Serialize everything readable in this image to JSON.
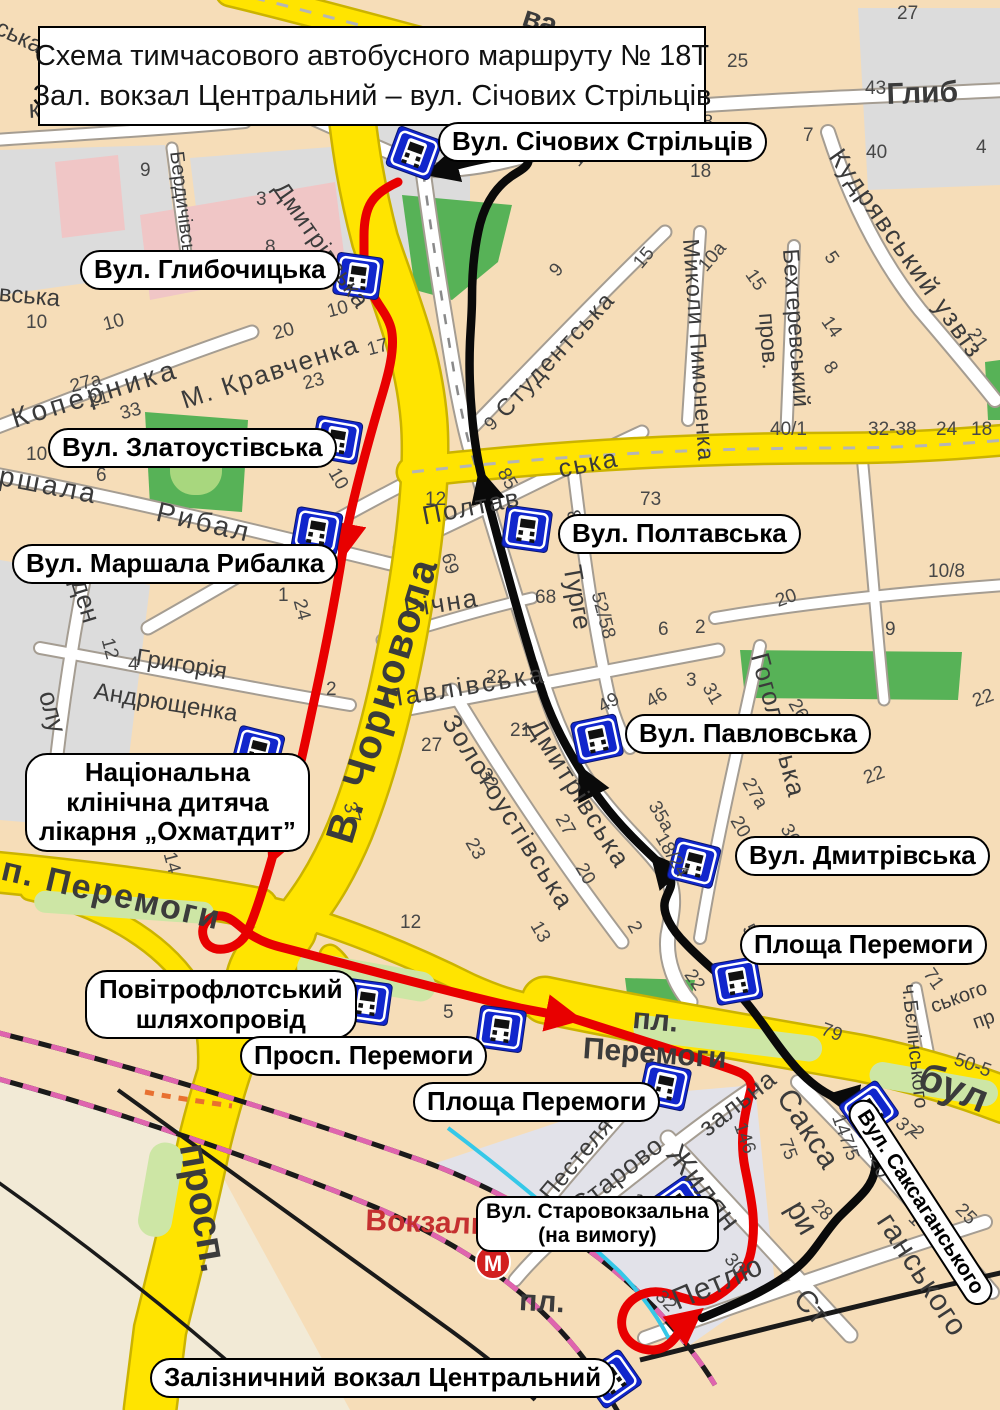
{
  "title": {
    "line1": "Схема тимчасового автобусного маршруту № 18Т",
    "line2": "Зал. вокзал Центральний  – вул. Січових Стрільців"
  },
  "colors": {
    "route_red": "#e80000",
    "route_black": "#0a0a0a",
    "road_yellow": "#ffe400",
    "road_yellow_casing": "#cbb300",
    "road_white": "#ffffff",
    "road_white_casing": "#a59d92",
    "stop_blue": "#1126cc",
    "land": "#f6ddb8",
    "land_gray": "#dcdcdc",
    "land_beige": "#f2ead6",
    "park_green": "#57b257",
    "pill_green": "#cde6a5",
    "block_pink": "#f0c6c6",
    "railway_pink": "#df64ae",
    "water_cyan": "#35c8e8",
    "metro_red": "#d21f1f"
  },
  "metro": {
    "label": "М"
  },
  "station_area_label": "Вокзаль",
  "stops": [
    {
      "id": "sichovykh-striltsiv",
      "lines": [
        "Вул. Січових Стрільців"
      ],
      "x": 438,
      "y": 122,
      "icon": {
        "x": 414,
        "y": 153,
        "r": 20
      }
    },
    {
      "id": "hlybochytska",
      "lines": [
        "Вул. Глибочицька"
      ],
      "x": 80,
      "y": 250,
      "icon": {
        "x": 358,
        "y": 276,
        "r": 8
      }
    },
    {
      "id": "zlatoustivska",
      "lines": [
        "Вул. Златоустівська"
      ],
      "x": 48,
      "y": 428,
      "icon": {
        "x": 337,
        "y": 440,
        "r": 10
      }
    },
    {
      "id": "marshala-rybalky",
      "lines": [
        "Вул. Маршала Рибалка"
      ],
      "x": 12,
      "y": 544,
      "icon": {
        "x": 317,
        "y": 531,
        "r": 10
      }
    },
    {
      "id": "poltavska",
      "lines": [
        "Вул. Полтавська"
      ],
      "x": 558,
      "y": 514,
      "icon": {
        "x": 527,
        "y": 529,
        "r": 8
      }
    },
    {
      "id": "pavlovska",
      "lines": [
        "Вул. Павловська"
      ],
      "x": 625,
      "y": 714,
      "icon": {
        "x": 597,
        "y": 739,
        "r": -12
      }
    },
    {
      "id": "dmytrivska",
      "lines": [
        "Вул. Дмитрівська"
      ],
      "x": 735,
      "y": 836,
      "icon": {
        "x": 694,
        "y": 863,
        "r": 14
      }
    },
    {
      "id": "ploshcha-peremohy-inbound",
      "lines": [
        "Площа Перемоги"
      ],
      "x": 740,
      "y": 925,
      "icon": {
        "x": 737,
        "y": 981,
        "r": -10
      }
    },
    {
      "id": "okhmatdyt",
      "lines": [
        "Національна",
        "клінічна дитяча",
        "лікарня „Охматдит”"
      ],
      "x": 25,
      "y": 753,
      "icon": {
        "x": 258,
        "y": 751,
        "r": 14
      }
    },
    {
      "id": "povitroflotskyi-shliakhoprovid",
      "lines": [
        "Повітрофлотський",
        "шляхопровід"
      ],
      "x": 85,
      "y": 970,
      "icon": {
        "x": 367,
        "y": 1002,
        "r": 8
      }
    },
    {
      "id": "prosp-peremohy",
      "lines": [
        "Просп. Перемоги"
      ],
      "x": 240,
      "y": 1036,
      "icon": {
        "x": 501,
        "y": 1029,
        "r": 8
      }
    },
    {
      "id": "ploshcha-peremohy-outbound",
      "lines": [
        "Площа Перемоги"
      ],
      "x": 413,
      "y": 1082,
      "icon": {
        "x": 665,
        "y": 1086,
        "r": 12
      }
    },
    {
      "id": "starovokzalna",
      "lines": [
        "Вул. Старовокзальна",
        "(на вимогу)"
      ],
      "x": 476,
      "y": 1196,
      "small": true,
      "icon": {
        "x": 679,
        "y": 1205,
        "r": -35
      }
    },
    {
      "id": "saksahanskoho",
      "lines": [
        "Вул. Саксаганського"
      ],
      "x": 868,
      "y": 1094,
      "rot": 57,
      "rotlbl": true,
      "icon": {
        "x": 869,
        "y": 1110,
        "r": -35
      }
    },
    {
      "id": "zaliznychnyi-vokzal-tsentralnyi",
      "lines": [
        "Залізничний вокзал Центральний"
      ],
      "x": 150,
      "y": 1358,
      "icon": {
        "x": 612,
        "y": 1379,
        "r": -35
      }
    }
  ],
  "streets": [
    {
      "t": "ва",
      "x": 528,
      "y": 2,
      "r": 18,
      "s": 30,
      "b": 1
    },
    {
      "t": "ська",
      "x": 2,
      "y": 16,
      "r": 25,
      "s": 24
    },
    {
      "t": "к'янівська пл.",
      "x": 28,
      "y": 96,
      "r": -3,
      "s": 26
    },
    {
      "t": "Бердичівська",
      "x": 186,
      "y": 150,
      "r": 83,
      "s": 20
    },
    {
      "t": "вська",
      "x": 0,
      "y": 282,
      "r": 5,
      "s": 24
    },
    {
      "t": "Глиб",
      "x": 886,
      "y": 80,
      "r": -2,
      "s": 30,
      "b": 1
    },
    {
      "t": "Студентська",
      "x": 492,
      "y": 406,
      "r": -47,
      "s": 24,
      "ls": 2
    },
    {
      "t": "Миколи Пимоненка",
      "x": 702,
      "y": 238,
      "r": 86,
      "s": 23,
      "ls": 1
    },
    {
      "t": "Бехтеревський",
      "x": 802,
      "y": 248,
      "r": 86,
      "s": 23
    },
    {
      "t": "пров.",
      "x": 778,
      "y": 312,
      "r": 86,
      "s": 23
    },
    {
      "t": "Кудрявський узвіз",
      "x": 846,
      "y": 144,
      "r": 55,
      "s": 26,
      "ls": 2
    },
    {
      "t": "Коперника",
      "x": 8,
      "y": 406,
      "r": -17,
      "s": 28,
      "ls": 4
    },
    {
      "t": "Дмитрівська",
      "x": 288,
      "y": 178,
      "r": 55,
      "s": 24,
      "ls": 1
    },
    {
      "t": "М. Кравченка",
      "x": 178,
      "y": 388,
      "r": -18,
      "s": 26,
      "ls": 2
    },
    {
      "t": "ршала",
      "x": 2,
      "y": 462,
      "r": 11,
      "s": 28,
      "ls": 3
    },
    {
      "t": "Рибал",
      "x": 160,
      "y": 498,
      "r": 13,
      "s": 28,
      "ls": 3
    },
    {
      "t": "ден",
      "x": 92,
      "y": 576,
      "r": 73,
      "s": 26
    },
    {
      "t": "олу",
      "x": 60,
      "y": 688,
      "r": 75,
      "s": 26
    },
    {
      "t": "Григорія",
      "x": 138,
      "y": 646,
      "r": 9,
      "s": 24
    },
    {
      "t": "Андрющенка",
      "x": 96,
      "y": 680,
      "r": 9,
      "s": 24
    },
    {
      "t": "В. Чорновола",
      "x": 320,
      "y": 836,
      "r": -73,
      "s": 40,
      "b": 1,
      "ls": 2
    },
    {
      "t": "Полтав",
      "x": 420,
      "y": 503,
      "r": -11,
      "s": 26,
      "ls": 2
    },
    {
      "t": "ська",
      "x": 556,
      "y": 456,
      "r": -11,
      "s": 26,
      "ls": 2
    },
    {
      "t": "Річна",
      "x": 402,
      "y": 596,
      "r": -9,
      "s": 26,
      "ls": 2
    },
    {
      "t": "Турге",
      "x": 585,
      "y": 563,
      "r": 80,
      "s": 26
    },
    {
      "t": "Павлівська",
      "x": 382,
      "y": 686,
      "r": -9,
      "s": 26,
      "ls": 3
    },
    {
      "t": "Золотоустівська",
      "x": 460,
      "y": 710,
      "r": 58,
      "s": 26,
      "ls": 2
    },
    {
      "t": "Дмитрівська",
      "x": 545,
      "y": 714,
      "r": 58,
      "s": 26,
      "ls": 2
    },
    {
      "t": "Гоголівська",
      "x": 772,
      "y": 650,
      "r": 75,
      "s": 26,
      "ls": 1
    },
    {
      "t": "п. Перемоги",
      "x": 6,
      "y": 852,
      "r": 13,
      "s": 34,
      "b": 1,
      "ls": 2
    },
    {
      "t": "пл.",
      "x": 634,
      "y": 1004,
      "r": 5,
      "s": 30,
      "b": 1
    },
    {
      "t": "Перемоги",
      "x": 584,
      "y": 1034,
      "r": 4,
      "s": 30,
      "b": 1
    },
    {
      "t": "ч.Бєлінського",
      "x": 918,
      "y": 983,
      "r": 84,
      "s": 20
    },
    {
      "t": "ського",
      "x": 928,
      "y": 998,
      "r": -20,
      "s": 20
    },
    {
      "t": "пр",
      "x": 970,
      "y": 1014,
      "r": -20,
      "s": 20
    },
    {
      "t": "бул",
      "x": 928,
      "y": 1056,
      "r": 22,
      "s": 40,
      "b": 1
    },
    {
      "t": "Сакса",
      "x": 796,
      "y": 1084,
      "r": 57,
      "s": 30,
      "ls": 1
    },
    {
      "t": "ганського",
      "x": 896,
      "y": 1208,
      "r": 57,
      "s": 30,
      "ls": 1
    },
    {
      "t": "Жилян",
      "x": 684,
      "y": 1140,
      "r": 52,
      "s": 30,
      "ls": 1
    },
    {
      "t": "ри",
      "x": 806,
      "y": 1196,
      "r": 60,
      "s": 30
    },
    {
      "t": "Петлю",
      "x": 668,
      "y": 1288,
      "r": -23,
      "s": 30,
      "ls": 1
    },
    {
      "t": "Пестеля",
      "x": 536,
      "y": 1190,
      "r": -50,
      "s": 24,
      "ls": 1
    },
    {
      "t": "Старово",
      "x": 566,
      "y": 1198,
      "r": -38,
      "s": 26,
      "ls": 1
    },
    {
      "t": "зальна",
      "x": 694,
      "y": 1120,
      "r": -38,
      "s": 26,
      "ls": 1
    },
    {
      "t": "просп.",
      "x": 212,
      "y": 1140,
      "r": 80,
      "s": 40,
      "b": 1
    },
    {
      "t": "Вокзаль",
      "x": 366,
      "y": 1206,
      "r": 2,
      "s": 30,
      "b": 1,
      "c": "#c53030"
    },
    {
      "t": "пл.",
      "x": 520,
      "y": 1286,
      "r": 3,
      "s": 30,
      "b": 1
    },
    {
      "t": "Ст",
      "x": 810,
      "y": 1284,
      "r": 48,
      "s": 30
    }
  ],
  "house_numbers": [
    [
      727,
      52,
      "25"
    ],
    [
      865,
      79,
      "43"
    ],
    [
      897,
      4,
      "27"
    ],
    [
      692,
      113,
      "28"
    ],
    [
      803,
      126,
      "7"
    ],
    [
      866,
      143,
      "40"
    ],
    [
      690,
      162,
      "18"
    ],
    [
      976,
      138,
      "4"
    ],
    [
      836,
      248,
      "5",
      55
    ],
    [
      757,
      266,
      "15",
      55
    ],
    [
      833,
      313,
      "14",
      55
    ],
    [
      835,
      358,
      "8",
      55
    ],
    [
      770,
      420,
      "40/1"
    ],
    [
      868,
      420,
      "32-38"
    ],
    [
      936,
      420,
      "24"
    ],
    [
      971,
      420,
      "18"
    ],
    [
      979,
      325,
      "21",
      55
    ],
    [
      567,
      158,
      "16",
      -50
    ],
    [
      546,
      268,
      "9",
      -50
    ],
    [
      630,
      260,
      "15",
      -50
    ],
    [
      695,
      263,
      "10а",
      -50
    ],
    [
      140,
      161,
      "9"
    ],
    [
      26,
      313,
      "10"
    ],
    [
      256,
      190,
      "3"
    ],
    [
      265,
      238,
      "8"
    ],
    [
      101,
      316,
      "10",
      -15
    ],
    [
      271,
      325,
      "20",
      -15
    ],
    [
      325,
      303,
      "10",
      -15
    ],
    [
      365,
      341,
      "17",
      -15
    ],
    [
      301,
      375,
      "23",
      -15
    ],
    [
      86,
      393,
      "21",
      -15
    ],
    [
      118,
      405,
      "33",
      -15
    ],
    [
      68,
      378,
      "27а",
      -15
    ],
    [
      26,
      445,
      "10"
    ],
    [
      96,
      466,
      "6"
    ],
    [
      341,
      465,
      "10",
      60
    ],
    [
      278,
      586,
      "1"
    ],
    [
      308,
      597,
      "24",
      75
    ],
    [
      116,
      636,
      "12",
      75
    ],
    [
      128,
      655,
      "4"
    ],
    [
      326,
      680,
      "2"
    ],
    [
      425,
      490,
      "12"
    ],
    [
      510,
      465,
      "85",
      60
    ],
    [
      481,
      421,
      "9",
      -45
    ],
    [
      456,
      551,
      "69",
      75
    ],
    [
      535,
      588,
      "68"
    ],
    [
      581,
      508,
      "80",
      75
    ],
    [
      640,
      490,
      "73"
    ],
    [
      606,
      590,
      "52/58",
      75
    ],
    [
      658,
      620,
      "6"
    ],
    [
      695,
      618,
      "2"
    ],
    [
      773,
      593,
      "20",
      -20
    ],
    [
      486,
      668,
      "22"
    ],
    [
      400,
      913,
      "12"
    ],
    [
      543,
      918,
      "13",
      60
    ],
    [
      686,
      671,
      "3"
    ],
    [
      715,
      680,
      "31",
      60
    ],
    [
      643,
      695,
      "46",
      -30
    ],
    [
      595,
      700,
      "49",
      -30
    ],
    [
      801,
      696,
      "26",
      60
    ],
    [
      970,
      693,
      "22",
      -20
    ],
    [
      755,
      775,
      "27а",
      60
    ],
    [
      743,
      813,
      "20",
      60
    ],
    [
      661,
      798,
      "35а",
      60
    ],
    [
      668,
      830,
      "18/24",
      60
    ],
    [
      793,
      821,
      "36",
      60
    ],
    [
      861,
      770,
      "22",
      -20
    ],
    [
      588,
      860,
      "20",
      60
    ],
    [
      568,
      811,
      "27",
      60
    ],
    [
      755,
      921,
      "51",
      60
    ],
    [
      640,
      918,
      "2",
      60
    ],
    [
      421,
      736,
      "27"
    ],
    [
      510,
      721,
      "21"
    ],
    [
      491,
      765,
      "32",
      60
    ],
    [
      478,
      835,
      "23",
      60
    ],
    [
      358,
      800,
      "37",
      75
    ],
    [
      178,
      850,
      "14",
      75
    ],
    [
      443,
      1003,
      "5"
    ],
    [
      935,
      965,
      "71",
      55
    ],
    [
      825,
      1020,
      "79",
      20
    ],
    [
      958,
      1050,
      "50-5",
      20
    ],
    [
      696,
      966,
      "22",
      55
    ],
    [
      639,
      1190,
      "17",
      40
    ],
    [
      735,
      1250,
      "30",
      50
    ],
    [
      665,
      1287,
      "32",
      45
    ],
    [
      905,
      1114,
      "37",
      45
    ],
    [
      920,
      1122,
      "2",
      45
    ],
    [
      821,
      1196,
      "28",
      45
    ],
    [
      965,
      1200,
      "25",
      45
    ],
    [
      918,
      1209,
      "1",
      45
    ],
    [
      879,
      1138,
      "-120",
      70
    ],
    [
      793,
      1136,
      "75",
      70
    ],
    [
      846,
      1112,
      "147/5",
      70
    ],
    [
      748,
      1120,
      "146",
      70
    ],
    [
      928,
      562,
      "10/8"
    ],
    [
      885,
      620,
      "9"
    ]
  ]
}
